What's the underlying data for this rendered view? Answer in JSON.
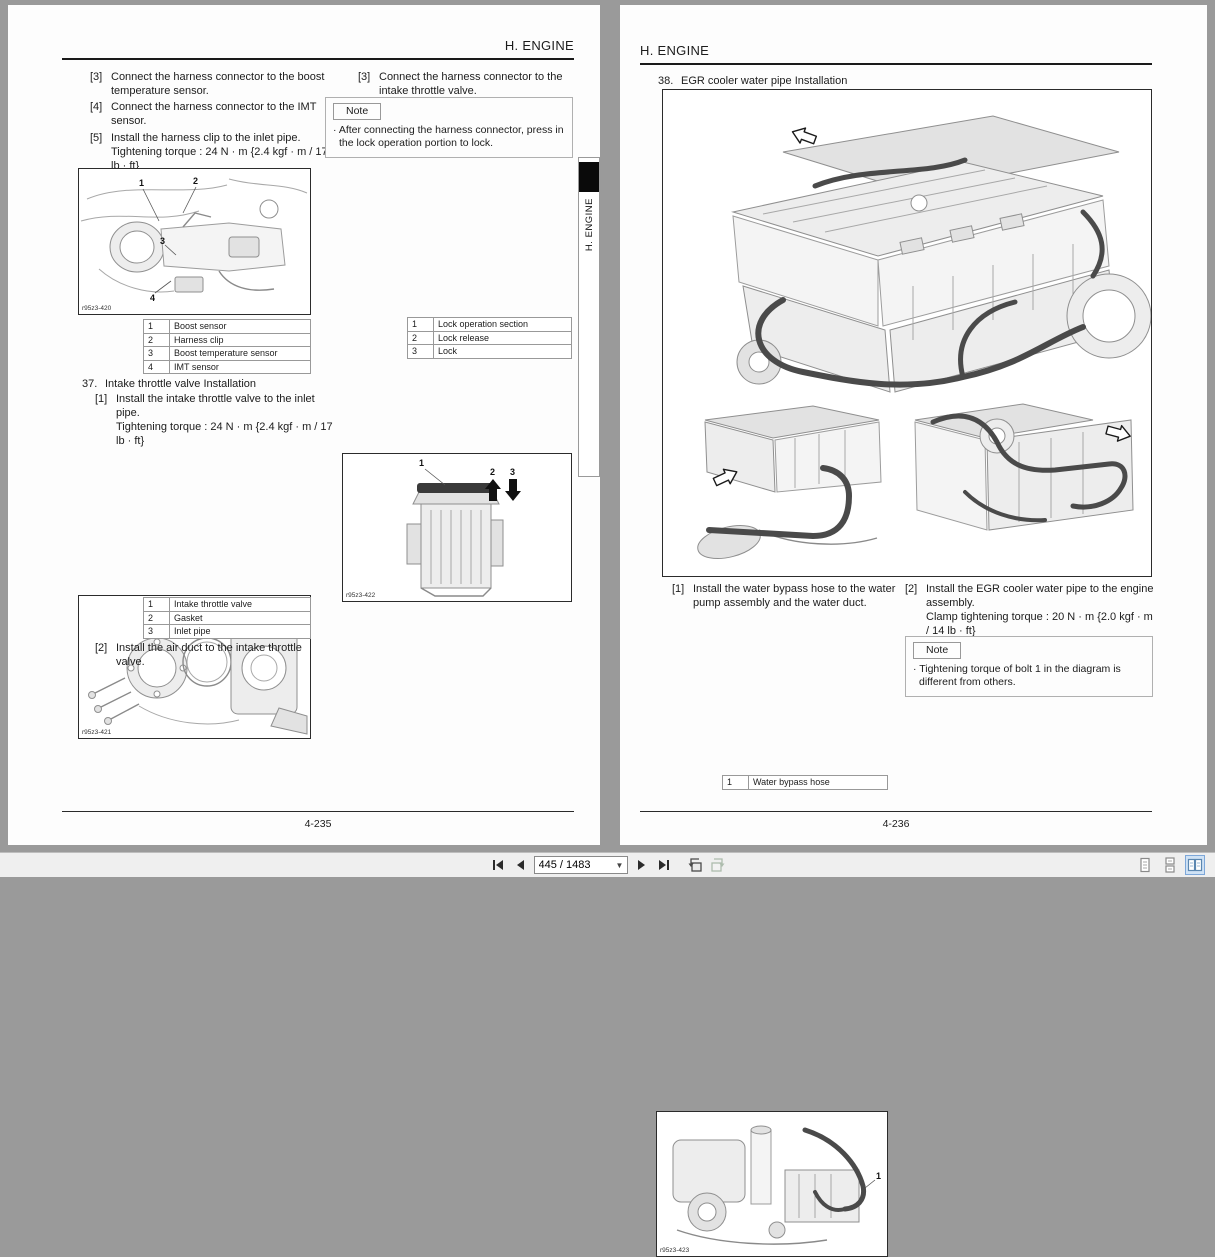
{
  "colors": {
    "selected_view_bg": "#cfe2f5",
    "page_bg": "#fdfdfd",
    "viewer_bg": "#9a9a9a"
  },
  "left_page": {
    "header": "H. ENGINE",
    "side_tab": "H. ENGINE",
    "footer": "4-235",
    "col1": {
      "step3": {
        "m": "[3]",
        "t": "Connect the harness connector to the boost temperature sensor."
      },
      "step4": {
        "m": "[4]",
        "t": "Connect the harness connector to the IMT sensor."
      },
      "step5": {
        "m": "[5]",
        "t": "Install the harness clip to the inlet pipe.",
        "torque": "Tightening torque :  24 N · m {2.4 kgf · m / 17 lb · ft}"
      },
      "fig1": {
        "label": "r95z3-420",
        "callouts": [
          "1",
          "2",
          "3",
          "4"
        ]
      },
      "table1": {
        "rows": [
          [
            "1",
            "Boost sensor"
          ],
          [
            "2",
            "Harness clip"
          ],
          [
            "3",
            "Boost temperature sensor"
          ],
          [
            "4",
            "IMT sensor"
          ]
        ]
      },
      "sec37": {
        "m": "37.",
        "t": "Intake throttle valve Installation"
      },
      "step37_1": {
        "m": "[1]",
        "t": "Install the intake throttle valve to the inlet pipe.",
        "torque": "Tightening torque :  24 N · m {2.4 kgf · m / 17 lb · ft}"
      },
      "fig2": {
        "label": "r95z3-421",
        "callouts": [
          "1",
          "2",
          "3"
        ]
      },
      "table2": {
        "rows": [
          [
            "1",
            "Intake throttle valve"
          ],
          [
            "2",
            "Gasket"
          ],
          [
            "3",
            "Inlet pipe"
          ]
        ]
      },
      "step37_2": {
        "m": "[2]",
        "t": "Install the air duct to the intake throttle valve."
      }
    },
    "col2": {
      "step3": {
        "m": "[3]",
        "t": "Connect the harness connector to the intake throttle valve."
      },
      "note": {
        "label": "Note",
        "text": "· After connecting the harness connector, press in the lock operation portion to lock."
      },
      "fig3": {
        "label": "r95z3-422",
        "callouts": [
          "1",
          "2",
          "3"
        ]
      },
      "table3": {
        "rows": [
          [
            "1",
            "Lock operation section"
          ],
          [
            "2",
            "Lock release"
          ],
          [
            "3",
            "Lock"
          ]
        ]
      }
    }
  },
  "right_page": {
    "header": "H. ENGINE",
    "footer": "4-236",
    "sec38": {
      "m": "38.",
      "t": "EGR cooler water pipe Installation"
    },
    "colA": {
      "step1": {
        "m": "[1]",
        "t": "Install the water bypass hose to the water pump assembly and the water duct."
      },
      "fig5": {
        "label": "r95z3-423",
        "callouts": [
          "1"
        ]
      },
      "table4": {
        "rows": [
          [
            "1",
            "Water bypass hose"
          ]
        ]
      }
    },
    "colB": {
      "step2": {
        "m": "[2]",
        "t": "Install the EGR cooler water pipe to the engine assembly.",
        "torque": "Clamp tightening torque :  20 N · m {2.0 kgf · m / 14 lb · ft}"
      },
      "note": {
        "label": "Note",
        "text": "· Tightening torque of bolt 1 in the diagram is different from others."
      }
    }
  },
  "toolbar": {
    "page_field": "445 / 1483"
  }
}
